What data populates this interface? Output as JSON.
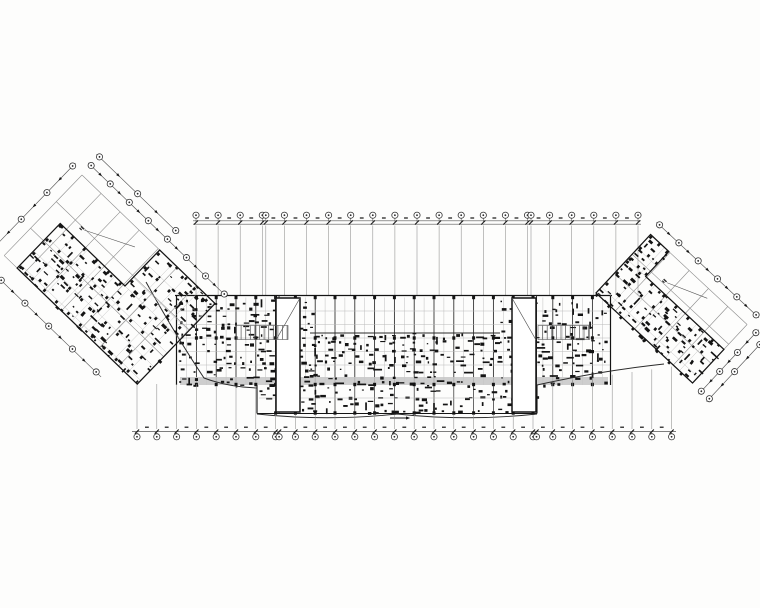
{
  "canvas": {
    "width": 760,
    "height": 608,
    "background": "#fdfdfc"
  },
  "colors": {
    "ink": "#141414",
    "dark": "#2a2a2a",
    "mid": "#555555",
    "grid": "#8d8d8d",
    "faint": "#b9b9b9",
    "corridor": "#c6c6c6",
    "paper": "#ffffff",
    "bubble_stroke": "#333333"
  },
  "seed": 1337,
  "bubble_radius": 3.1,
  "top_dimension": {
    "rail_ys": [
      220.8,
      224.2
    ],
    "x0": 193,
    "x1": 641,
    "station_x0": 196,
    "station_step": 22.1,
    "station_count": 21,
    "pair_extras": [
      [
        3,
        3.5
      ],
      [
        15,
        3.5
      ]
    ],
    "bubble_cy": 215.2,
    "dash_y": 218.0
  },
  "bottom_dimension": {
    "rail_ys": [
      431.6
    ],
    "x0": 132,
    "x1": 676,
    "station_x0": 137,
    "station_step": 19.8,
    "station_count": 28,
    "pair_extras": [
      [
        7,
        3.5
      ],
      [
        20,
        3.5
      ]
    ],
    "bubble_cy": 436.8,
    "dash_y": 427.2
  },
  "upper_grid": {
    "y0": 225.5,
    "y1": 295
  },
  "band": {
    "x0": 175,
    "x1": 612,
    "y_top": 295.5,
    "y_bot": 385,
    "clutter_rects": [
      [
        178,
        299,
        310,
        384
      ],
      [
        310,
        333,
        500,
        384
      ],
      [
        500,
        299,
        610,
        384
      ]
    ],
    "h_lines": [
      311,
      324.5,
      338,
      351.5,
      365
    ],
    "mid_dark_line": {
      "y": 333,
      "x0": 310,
      "x1": 500
    },
    "corridor": {
      "x0": 180,
      "x1": 608,
      "y0": 377,
      "y1": 385
    },
    "column_ys": [
      297.5,
      338,
      384.5
    ],
    "double_axes": [
      [
        275.5,
        279
      ],
      [
        533,
        536.5
      ]
    ]
  },
  "protrusion": {
    "x0": 257,
    "x1": 537,
    "y0": 385,
    "y1": 413.5,
    "arc_mid": 397,
    "arc_sag": 8,
    "h_line": 398,
    "clutter": [
      258,
      387,
      536,
      411
    ],
    "column_y": 413
  },
  "stairwells": [
    {
      "x": 276,
      "y": 298,
      "w": 24,
      "h": 114,
      "diag": "up",
      "rungs": {
        "x0": 236.5,
        "x1": 288,
        "y0": 325.5,
        "y1": 339.5,
        "step": 4.6
      }
    },
    {
      "x": 512,
      "y": 298,
      "w": 24,
      "h": 114,
      "diag": "down",
      "rungs": {
        "x0": 538,
        "x1": 589.5,
        "y0": 325.5,
        "y1": 339.5,
        "step": 4.6
      }
    }
  ],
  "facade_curves": [
    "M146,282 Q176,336 204,378 Q228,387 257,388",
    "M537,385 Q600,371 664,364"
  ],
  "extension_lines": {
    "y_bot": 429,
    "rules": [
      {
        "x_max": 205,
        "y_top": 384
      },
      {
        "x_max": 257,
        "y_top": 386
      },
      {
        "x_max": 538,
        "y_top": 415
      },
      {
        "x_max": 999,
        "interp": [
          538,
          385,
          676,
          366
        ]
      }
    ]
  },
  "leader_arrow": {
    "x0": 390,
    "x1": 408,
    "y": 418
  },
  "wings": {
    "left": {
      "translate": [
        82,
        175
      ],
      "rotate": 44,
      "long_ys": [
        0,
        37,
        74,
        112
      ],
      "x0": 0,
      "x1": 185,
      "cross_stations": [
        0,
        26.5,
        53,
        79.5,
        106,
        132.5,
        159,
        185
      ],
      "dense_polygon": [
        [
          18,
          50
        ],
        [
          108,
          50
        ],
        [
          108,
          0
        ],
        [
          185,
          0
        ],
        [
          185,
          112
        ],
        [
          18,
          112
        ]
      ],
      "dense_rects": [
        [
          18,
          50,
          185,
          112
        ],
        [
          108,
          0,
          185,
          50
        ]
      ],
      "fine_step": 19,
      "columns": [
        {
          "x0": 20,
          "x1": 183,
          "dx": 16.6,
          "y0": 52,
          "y1": 113,
          "dy": 19
        },
        {
          "x0": 110,
          "x1": 183,
          "dx": 16.6,
          "y0": 4,
          "y1": 49,
          "dy": 19
        }
      ],
      "rails": [
        {
          "axis": "x",
          "y": -13,
          "a0": 0,
          "a1": 185,
          "stations": [
            0,
            26.5,
            53,
            79.5,
            106,
            132.5,
            159,
            185
          ]
        },
        {
          "axis": "x",
          "y": -25,
          "a0": 0,
          "a1": 106,
          "stations": [
            0,
            53,
            106
          ]
        },
        {
          "axis": "y",
          "x": -13,
          "a0": 0,
          "a1": 112,
          "stations": [
            0,
            37,
            74,
            112
          ]
        },
        {
          "axis": "x",
          "y": 132,
          "a0": 12,
          "a1": 150,
          "stations": [
            15,
            48,
            81,
            114,
            147
          ]
        }
      ],
      "leader": [
        [
          40,
          38
        ],
        [
          88,
          15
        ]
      ]
    },
    "right": {
      "translate": [
        596,
        293
      ],
      "rotate": 43,
      "long_ys": [
        -80,
        -53,
        -27,
        0
      ],
      "x0": 0,
      "x1": 132,
      "cross_stations": [
        0,
        26.4,
        52.8,
        79.2,
        105.6,
        132
      ],
      "dense_polygon": [
        [
          0,
          -80
        ],
        [
          25,
          -80
        ],
        [
          25,
          -46
        ],
        [
          132,
          -46
        ],
        [
          132,
          0
        ],
        [
          0,
          0
        ]
      ],
      "dense_rects": [
        [
          0,
          -46,
          132,
          0
        ],
        [
          0,
          -80,
          25,
          -46
        ]
      ],
      "fine_step": 19,
      "columns": [
        {
          "x0": 2,
          "x1": 131,
          "dx": 16.5,
          "y0": -44,
          "y1": 1,
          "dy": 15
        },
        {
          "x0": 2,
          "x1": 24,
          "dx": 11,
          "y0": -78,
          "y1": -48,
          "dy": 15
        }
      ],
      "rails": [
        {
          "axis": "x",
          "y": -93,
          "a0": 0,
          "a1": 132,
          "stations": [
            0,
            26.4,
            52.8,
            79.2,
            105.6,
            132
          ]
        },
        {
          "axis": "y",
          "x": 144,
          "a0": -80,
          "a1": 0,
          "stations": [
            -80,
            -53,
            -27,
            0
          ]
        },
        {
          "axis": "y",
          "x": 155,
          "a0": -74,
          "a1": 0,
          "stations": [
            -74,
            -37,
            0
          ]
        }
      ],
      "leader": [
        [
          45,
          -56
        ],
        [
          85,
          -72
        ]
      ]
    }
  },
  "clutter": {
    "cell": 6.8,
    "density": 0.5,
    "wing_cell": 7,
    "wing_density": 0.48
  }
}
